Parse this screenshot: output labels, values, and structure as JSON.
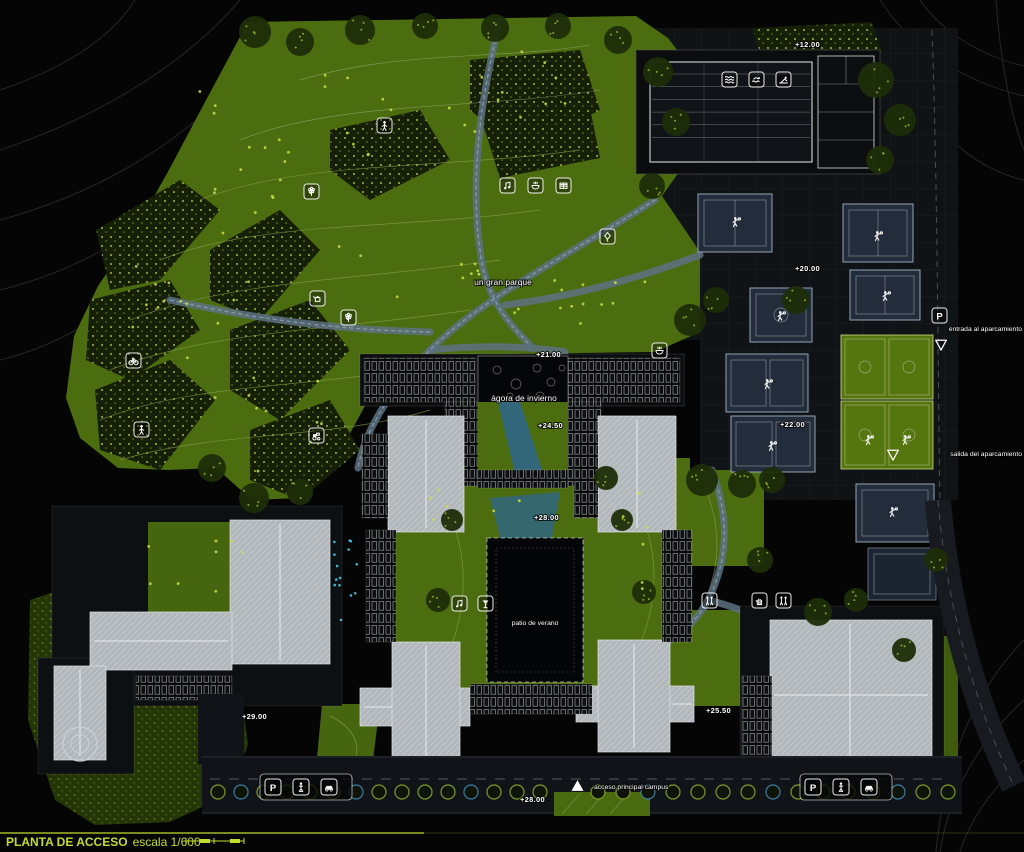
{
  "title": {
    "name": "PLANTA DE ACCESO",
    "scale": "escala 1/600"
  },
  "labels": {
    "park": "un gran parque",
    "winter_agora": "ágora de invierno",
    "summer_patio": "patio de verano",
    "main_access": "acceso principal campus",
    "parking_entry": "entrada al aparcamiento",
    "parking_exit": "salida del aparcamiento"
  },
  "elevations": [
    "+12.00",
    "+20.00",
    "+21.00",
    "+22.00",
    "+24.50",
    "+25.50",
    "+28.00",
    "+28.00",
    "+29.00"
  ],
  "icons": {
    "parking_glyph": "P",
    "semantic_names": [
      "flower-icon",
      "hiker-icon",
      "watering-can-icon",
      "plant-icon",
      "music-icon",
      "picnic-bowl-icon",
      "book-icon",
      "kite-icon",
      "bicycle-icon",
      "walker-icon",
      "tractor-icon",
      "waves-icon",
      "swimmer-icon",
      "sunbather-icon",
      "people-icon",
      "hand-icon",
      "cocktail-icon",
      "parking-icon",
      "motorbike-icon",
      "car-icon",
      "triangle-up-icon",
      "triangle-down-icon",
      "sports-player-icon"
    ]
  },
  "colors": {
    "background": "#050505",
    "park_green": "#4c6c10",
    "dark_vegetation": "#1a2408",
    "tree_speckle": "#c9e04a",
    "paved": "#101316",
    "court_blue": "#222c3a",
    "field_green": "#55750f",
    "building_roof": "#b2b7bb",
    "gravel_path": "#5d7183",
    "water": "#2f6687",
    "accent_title": "#c3dc32",
    "label_text": "#ffffff"
  }
}
